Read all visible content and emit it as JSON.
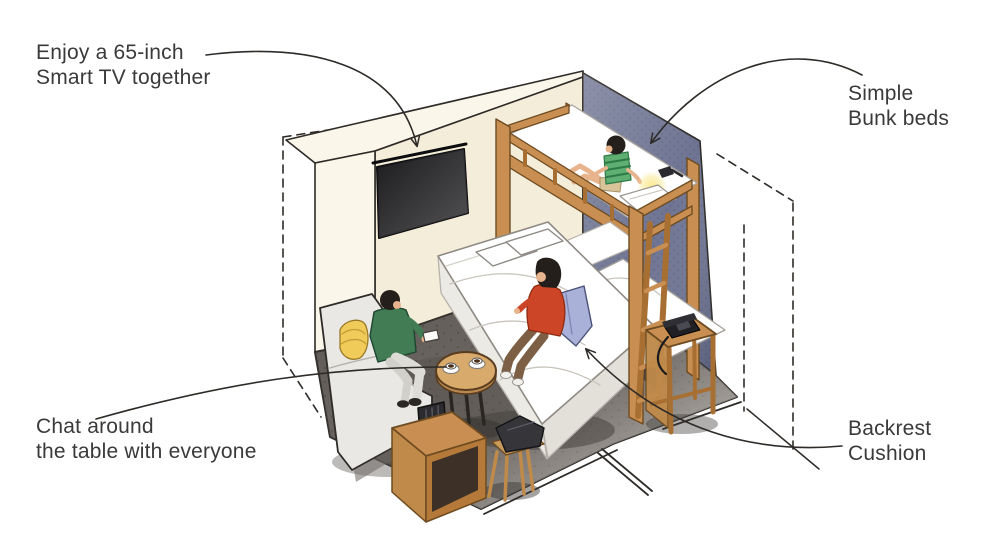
{
  "labels": {
    "tv": {
      "line1": "Enjoy a 65-inch",
      "line2": "Smart TV together"
    },
    "bunk": {
      "line1": "Simple",
      "line2": "Bunk beds"
    },
    "chat": {
      "line1": "Chat around",
      "line2": "the table with everyone"
    },
    "cushion": {
      "line1": "Backrest",
      "line2": "Cushion"
    }
  },
  "palette": {
    "background": "#ffffff",
    "text": "#3a3a3a",
    "line": "#2e2b28",
    "wall_cream": "#f3edda",
    "wall_cream_light": "#faf6e9",
    "accent_wall_blue": "#6e7492",
    "accent_wall_blue_dark": "#555b78",
    "floor_dark": "#5c5753",
    "floor_light": "#b3aea8",
    "wood": "#c98f52",
    "wood_dark": "#a86f33",
    "bedding": "#ffffff",
    "bedding_shade": "#eceae5",
    "sofa": "#e9e8e4",
    "pillow_yellow": "#f1cb5a",
    "cushion_blue": "#a9b1d8",
    "sweater_green": "#417c54",
    "shirt_red": "#cd4527",
    "pants_brown": "#7d5f45",
    "skin": "#e8b48d",
    "hair": "#241f1b",
    "tv_screen": "#1b1b1d",
    "lamp_glow": "#f9e98e",
    "phone_black": "#1f1f24",
    "device_black": "#2c2c30"
  },
  "scene": {
    "objects": [
      "wall-mounted-tv",
      "bunk-bed",
      "double-bed",
      "backrest-cushion",
      "sofa",
      "round-table",
      "coffee-cups",
      "stool",
      "cabinet",
      "media-device",
      "nightstand",
      "telephone",
      "reading-light"
    ],
    "people": [
      "person-on-sofa",
      "person-on-bed",
      "child-on-top-bunk"
    ]
  }
}
